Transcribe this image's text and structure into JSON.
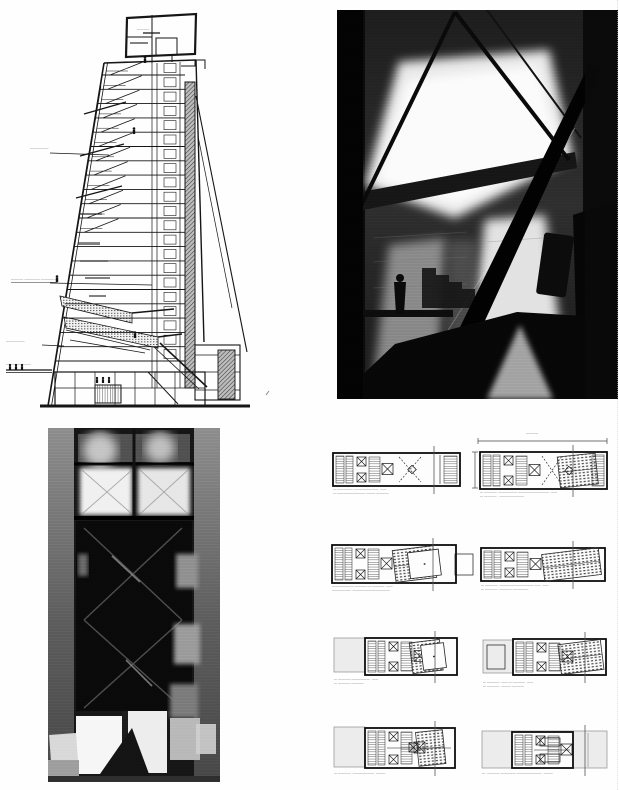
{
  "page": {
    "kind": "scanned architecture book page",
    "background": "#fefefe"
  },
  "section_figure": {
    "annotations": {
      "roof_box_label": "――――",
      "upper_left_label": "――――――",
      "mid_left_label": "―――― ――――― ――――·―",
      "lower_left_label": "――――――",
      "ground_label": "――――――――"
    }
  },
  "photos": {
    "interior_model": {
      "description_name": "model-photo-interior",
      "tone_dark": "#0a0a0a",
      "tone_light": "#e8e8e8"
    },
    "facade_model": {
      "description_name": "model-photo-facade",
      "tone_dark": "#111111",
      "tone_light": "#f2f2f2"
    }
  },
  "plans": {
    "dim_top_label": "――――",
    "items": [
      {
        "caption1": "―·――――― ――――――――  ――",
        "caption2": "―·――――――――― ――― ――――"
      },
      {
        "caption1": "― ――――· ―――――― ――――――――――  ――",
        "caption2": "― ―――― · ――――――――"
      },
      {
        "caption1": "――――――― ――――·― ――――  ――",
        "caption2": "―――――― ·――――――――――――"
      },
      {
        "caption1": "― ――――· ――――――――――― ――  ――",
        "caption2": "― ―――― ·―――― ―――――"
      },
      {
        "caption1": "― ――――·――――――  ――",
        "caption2": "― ―――― ――――"
      },
      {
        "caption1": "― ―――― ·――·― ――――  ――",
        "caption2": "― ―――― ·――― ――――"
      },
      {
        "caption1": "― ――――· ―――――――  ―――",
        "caption2": ""
      },
      {
        "caption1": "―· ―――― ――――― ――――――――  ―――",
        "caption2": ""
      }
    ]
  }
}
